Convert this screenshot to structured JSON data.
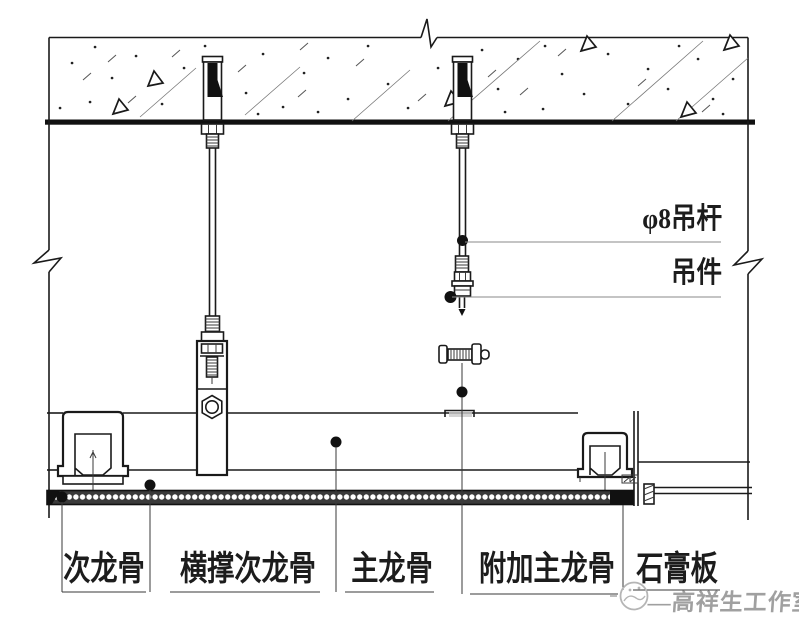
{
  "diagram": {
    "annotations": {
      "rod": "φ8吊杆",
      "hanger": "吊件"
    },
    "part_labels": [
      "次龙骨",
      "横撑次龙骨",
      "主龙骨",
      "附加主龙骨",
      "石膏板"
    ],
    "watermark": "—高祥生工作室",
    "colors": {
      "line": "#1a1a1a",
      "watermark": "#a0a0a0",
      "background": "#ffffff"
    }
  }
}
